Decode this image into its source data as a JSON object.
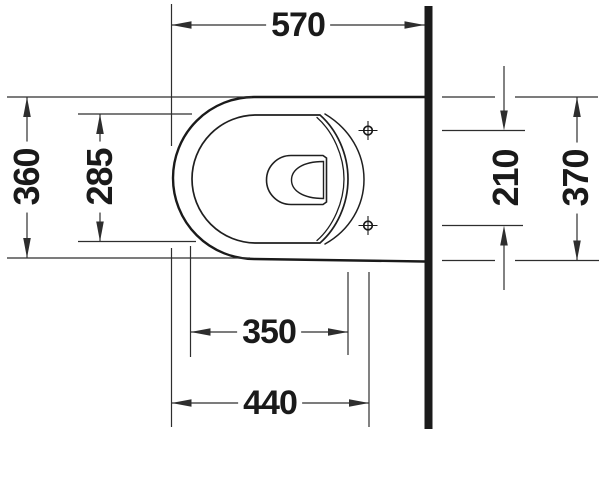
{
  "dims": {
    "overall_depth": {
      "value": "570"
    },
    "outer_width": {
      "value": "360"
    },
    "inner_bowl_width": {
      "value": "285"
    },
    "fixing_hole_spacing": {
      "value": "210"
    },
    "rear_width": {
      "value": "370"
    },
    "inner_bowl_depth": {
      "value": "350"
    },
    "front_to_fixing_holes": {
      "value": "440"
    }
  },
  "colors": {
    "thin_line": "#2e2e2e",
    "outline": "#1a1a1a",
    "wall_fill": "#1b1b1b",
    "background": "#ffffff"
  }
}
